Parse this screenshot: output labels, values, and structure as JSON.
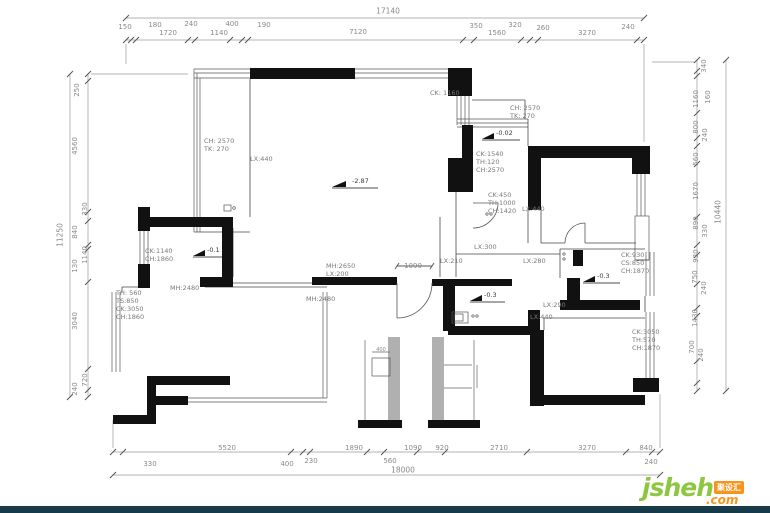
{
  "logo": {
    "brand": "jsheh",
    "tld": ".com",
    "badge": "聚设汇"
  },
  "colors": {
    "wall": "#111111",
    "line": "#555555",
    "dim_text": "#8a8a8a",
    "brand_green": "#8dc63f",
    "brand_orange": "#f7941d",
    "bottom_bar": "#173a48"
  },
  "dims": {
    "top": {
      "overall": "17140",
      "main": [
        "1720",
        "1140",
        "7120",
        "1560",
        "3270"
      ],
      "small": [
        "150",
        "180",
        "240",
        "400",
        "190",
        "350",
        "320",
        "260",
        "240"
      ]
    },
    "bottom": {
      "overall": "18000",
      "main": [
        "5520",
        "1890",
        "1090",
        "920",
        "2710",
        "3270",
        "840"
      ],
      "small": [
        "330",
        "400",
        "230",
        "560",
        "240"
      ]
    },
    "left": {
      "overall": "11250",
      "labels": [
        "250",
        "4560",
        "330",
        "840",
        "130",
        "1140",
        "3040",
        "720",
        "240"
      ]
    },
    "right": {
      "overall": "10440",
      "labels": [
        "340",
        "160",
        "1160",
        "800",
        "240",
        "560",
        "1670",
        "890",
        "330",
        "930",
        "750",
        "240",
        "1430",
        "700",
        "240"
      ]
    }
  },
  "door_dim": "1090",
  "detail_dim": "400",
  "annotations": [
    {
      "text": "CH:  2570\nTK:   270"
    },
    {
      "text": "LX:440"
    },
    {
      "text": "CK: 1160"
    },
    {
      "text": "CH:  2570\nTK:   270"
    },
    {
      "text": "CK:1540\nTH:120\nCH:2570"
    },
    {
      "text": "CK:450\nTH:1000\nCH:1420"
    },
    {
      "text": "LX:440"
    },
    {
      "text": "LX:300"
    },
    {
      "text": "LX:210"
    },
    {
      "text": "LX:280"
    },
    {
      "text": "CK:930\nCS:850\nCH:1870"
    },
    {
      "text": "CK:1140\nCH:1860"
    },
    {
      "text": "MH:2650\nLX:200"
    },
    {
      "text": "MH:2480"
    },
    {
      "text": "MH:2480"
    },
    {
      "text": "TH: 560\nTS:850\nCK:3050\nCH:1860"
    },
    {
      "text": "LX:290"
    },
    {
      "text": "LX:440"
    },
    {
      "text": "CK:3050\nTH:570\nCH:1870"
    }
  ],
  "levels": [
    {
      "text": "-2.87"
    },
    {
      "text": "-0.02"
    },
    {
      "text": "-0.1"
    },
    {
      "text": "-0.3"
    },
    {
      "text": "-0.3"
    }
  ]
}
